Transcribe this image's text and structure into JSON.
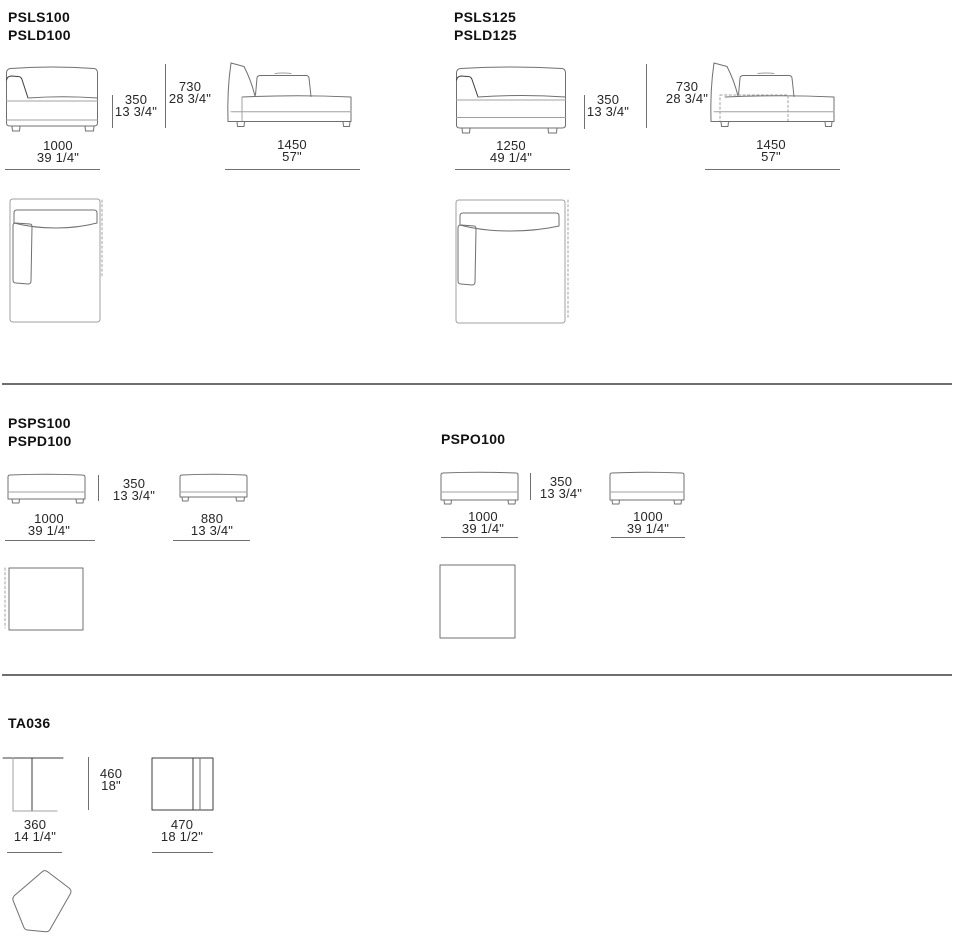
{
  "colors": {
    "background": "#ffffff",
    "line_light": "#a0a0a0",
    "line_mid": "#707070",
    "line_dark": "#3c3c3c",
    "text": "#1f1f1f",
    "divider": "#6e6e6e"
  },
  "sections": {
    "top_left": {
      "models": [
        "PSLS100",
        "PSLD100"
      ],
      "front": {
        "seat_mm": "350",
        "seat_in": "13 3/4\"",
        "height_mm": "730",
        "height_in": "28 3/4\"",
        "width_mm": "1000",
        "width_in": "39 1/4\""
      },
      "side": {
        "width_mm": "1450",
        "width_in": "57\""
      }
    },
    "top_right": {
      "models": [
        "PSLS125",
        "PSLD125"
      ],
      "front": {
        "seat_mm": "350",
        "seat_in": "13 3/4\"",
        "height_mm": "730",
        "height_in": "28 3/4\"",
        "width_mm": "1250",
        "width_in": "49 1/4\""
      },
      "side": {
        "width_mm": "1450",
        "width_in": "57\""
      }
    },
    "mid_left": {
      "models": [
        "PSPS100",
        "PSPD100"
      ],
      "height": {
        "mm": "350",
        "in": "13 3/4\""
      },
      "bench1": {
        "width_mm": "1000",
        "width_in": "39 1/4\""
      },
      "bench2": {
        "width_mm": "880",
        "width_in": "13 3/4\""
      }
    },
    "mid_right": {
      "models": [
        "PSPO100"
      ],
      "height": {
        "mm": "350",
        "in": "13 3/4\""
      },
      "bench1": {
        "width_mm": "1000",
        "width_in": "39 1/4\""
      },
      "bench2": {
        "width_mm": "1000",
        "width_in": "39 1/4\""
      }
    },
    "bottom": {
      "models": [
        "TA036"
      ],
      "height": {
        "mm": "460",
        "in": "18\""
      },
      "view1": {
        "width_mm": "360",
        "width_in": "14 1/4\""
      },
      "view2": {
        "width_mm": "470",
        "width_in": "18 1/2\""
      }
    }
  }
}
